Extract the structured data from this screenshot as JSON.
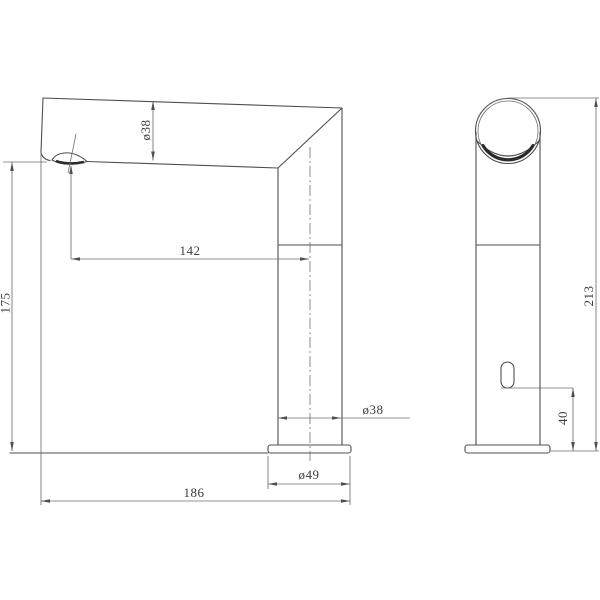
{
  "drawing": {
    "front_view": {
      "spout_diameter": "ø38",
      "spout_reach": "142",
      "spout_height": "175",
      "body_diameter": "ø38",
      "base_diameter": "ø49",
      "overall_length": "186"
    },
    "side_view": {
      "overall_height": "213",
      "sensor_height": "40"
    },
    "colors": {
      "line": "#4f4f4f",
      "dim_line": "#6f6f6f",
      "text": "#3c3c3c",
      "background": "#ffffff"
    }
  }
}
